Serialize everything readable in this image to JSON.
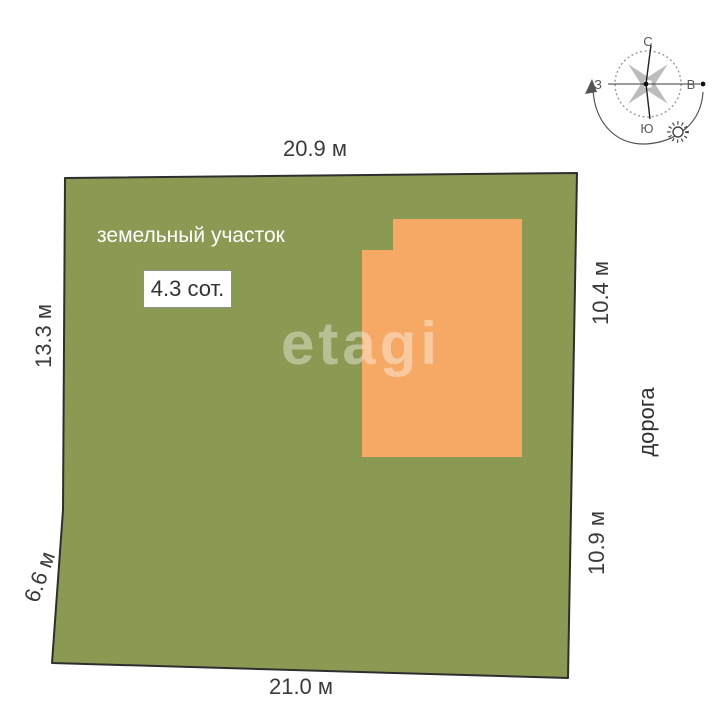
{
  "plot": {
    "label": "земельный участок",
    "area_badge": "4.3 сот."
  },
  "road": {
    "label": "дорога"
  },
  "dimensions": {
    "top": "20.9 м",
    "bottom": "21.0 м",
    "left_upper": "13.3 м",
    "left_lower": "6.6 м",
    "right_upper": "10.4 м",
    "right_lower": "10.9 м"
  },
  "compass": {
    "north": "С",
    "south": "Ю",
    "west": "З",
    "east": "В"
  },
  "watermark": "etagi",
  "colors": {
    "plot_fill": "#8b9a53",
    "building_fill": "#f5a965",
    "outline": "#2e2e2e"
  }
}
